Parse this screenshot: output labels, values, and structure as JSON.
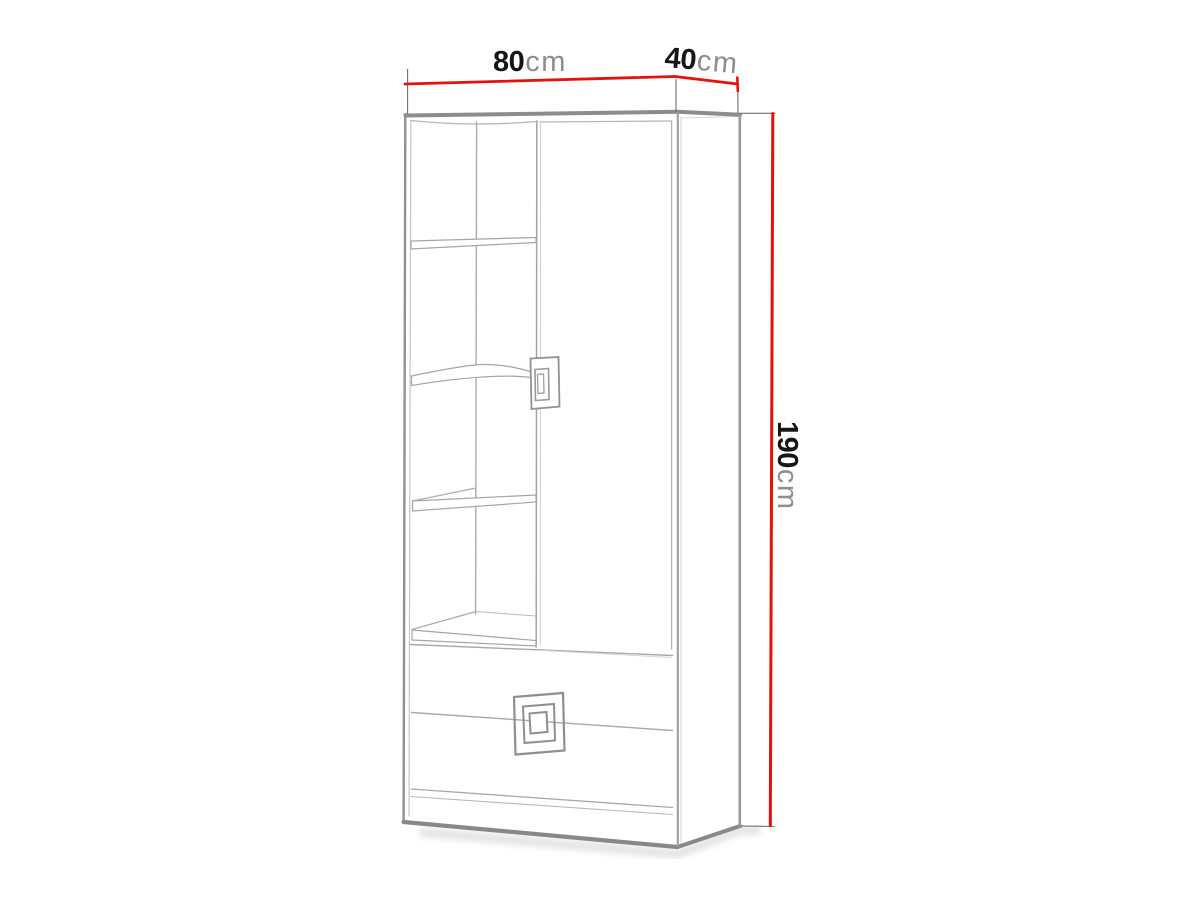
{
  "diagram": {
    "dimensions": {
      "width": {
        "value": "80",
        "unit": "cm"
      },
      "depth": {
        "value": "40",
        "unit": "cm"
      },
      "height": {
        "value": "190",
        "unit": "cm"
      }
    },
    "colors": {
      "dimension_line": "#e3120b",
      "drawing_outline": "#8a8a8a",
      "drawing_line_light": "#b4b4b4",
      "value_text": "#161616",
      "unit_text": "#8d8d8d",
      "background": "#ffffff"
    }
  }
}
